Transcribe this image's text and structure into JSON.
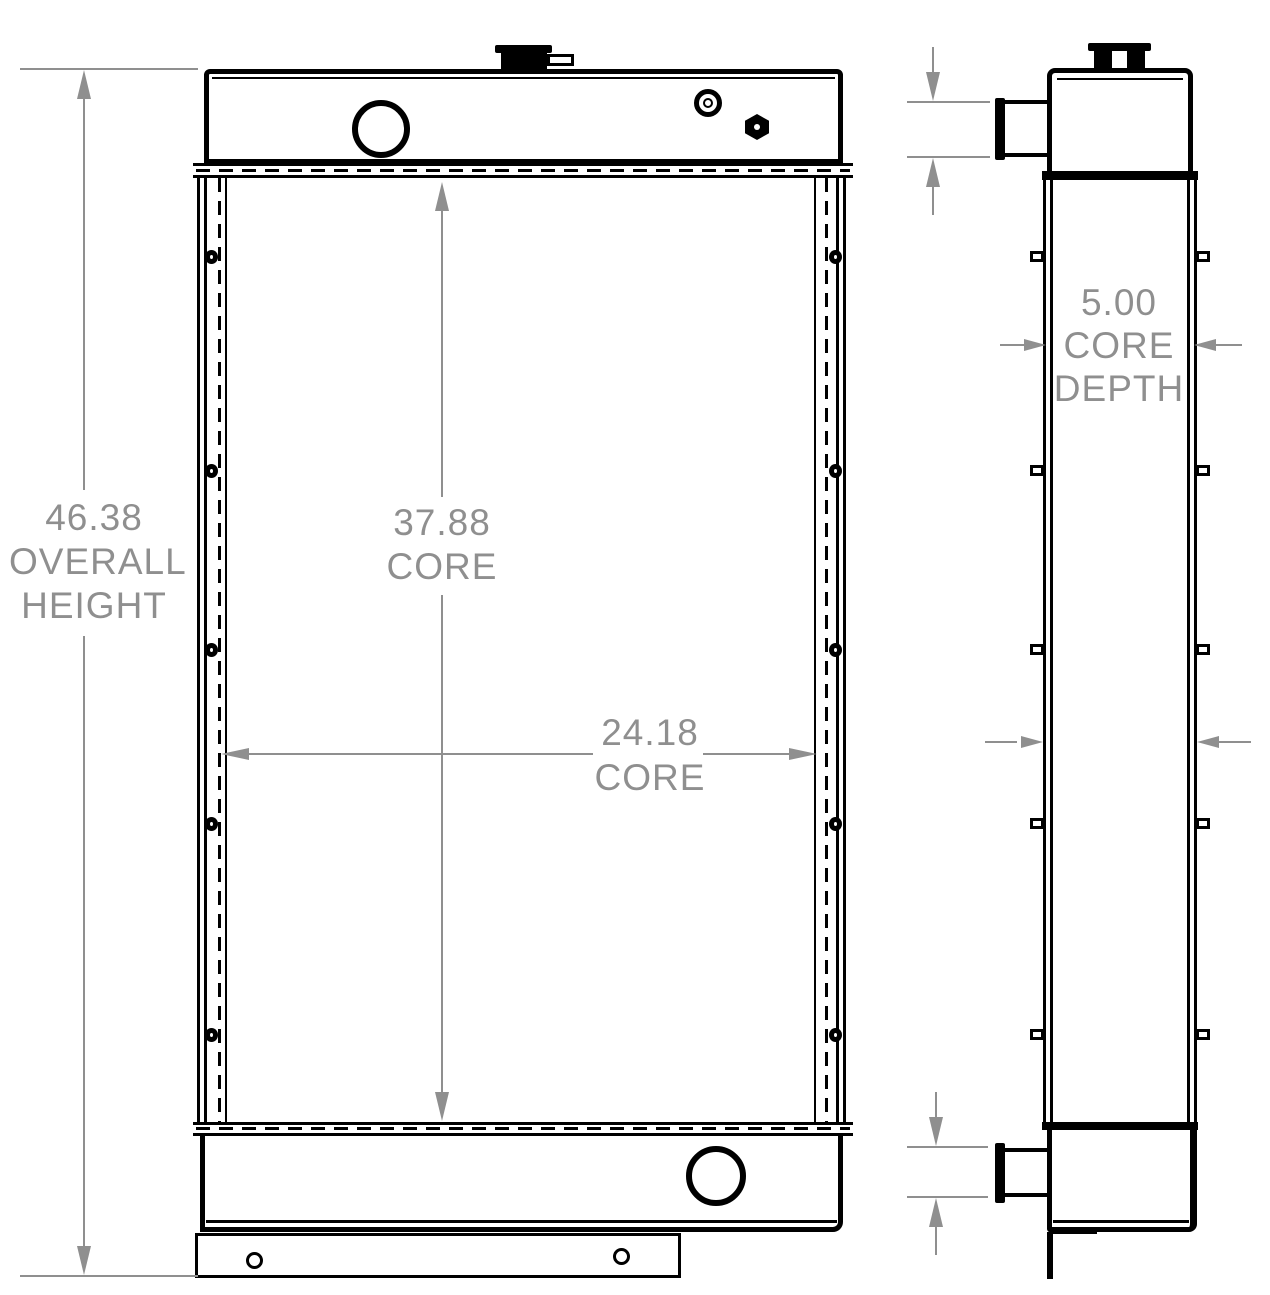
{
  "drawing": {
    "type": "radiator engineering drawing, front and side views",
    "background_color": "#ffffff",
    "object_line_color": "#000000",
    "dimension_color": "#8f8f8f",
    "dimensions": {
      "overall_height": {
        "line1": "46.38",
        "line2": "OVERALL",
        "line3": "HEIGHT"
      },
      "core_height": {
        "line1": "37.88",
        "line2": "CORE"
      },
      "core_width": {
        "line1": "24.18",
        "line2": "CORE"
      },
      "top_pipe_diameter": {
        "text": "Ø2.25"
      },
      "core_depth": {
        "line1": "5.00",
        "line2": "CORE",
        "line3": "DEPTH"
      },
      "over_side_panels": {
        "line1": "5.88",
        "line2": "OVER",
        "line3": "SIDE",
        "line4": "PANELS"
      },
      "bottom_pipe_diameter": {
        "text": "Ø2.00"
      }
    }
  }
}
